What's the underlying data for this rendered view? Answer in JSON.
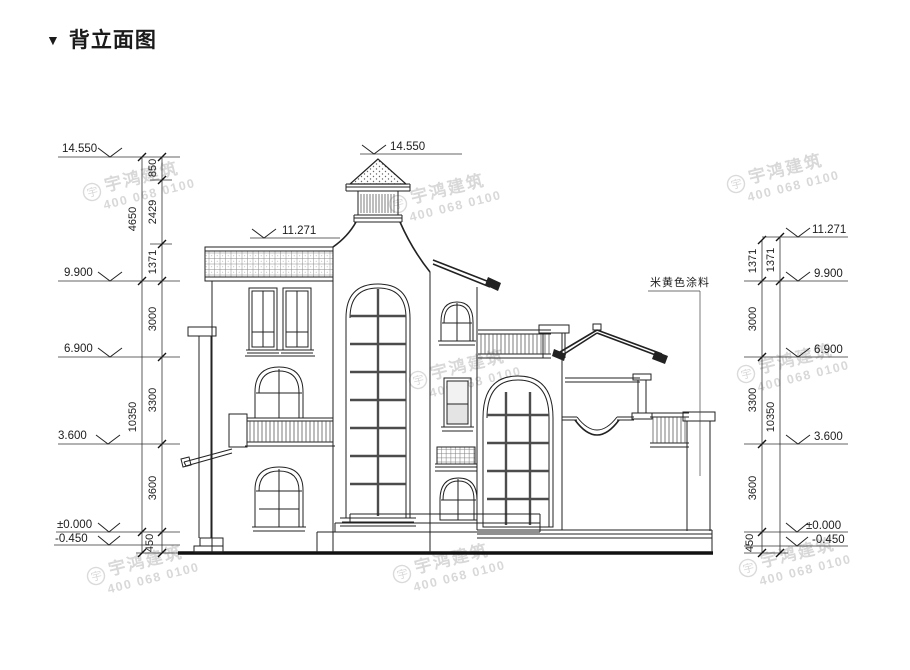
{
  "title": {
    "marker": "▼",
    "text": "背立面图"
  },
  "annotation": {
    "paint": "米黄色涂料"
  },
  "markers": {
    "top": "14.550",
    "roof": "11.271",
    "left": [
      "14.550",
      "9.900",
      "6.900",
      "3.600",
      "±0.000",
      "-0.450"
    ],
    "right": [
      "11.271",
      "9.900",
      "6.900",
      "3.600",
      "±0.000",
      "-0.450"
    ]
  },
  "dims": {
    "left_inner": [
      "850",
      "2429",
      "1371",
      "3000",
      "3300",
      "3600",
      "450"
    ],
    "left_outer": [
      "4650",
      "10350"
    ],
    "right_inner": [
      "1371",
      "3000",
      "3300",
      "3600",
      "450"
    ],
    "right_outer": [
      "1371",
      "10350"
    ]
  },
  "watermark": {
    "logo": "宇",
    "name": "宇鸿建筑",
    "phone": "400 068 0100"
  }
}
